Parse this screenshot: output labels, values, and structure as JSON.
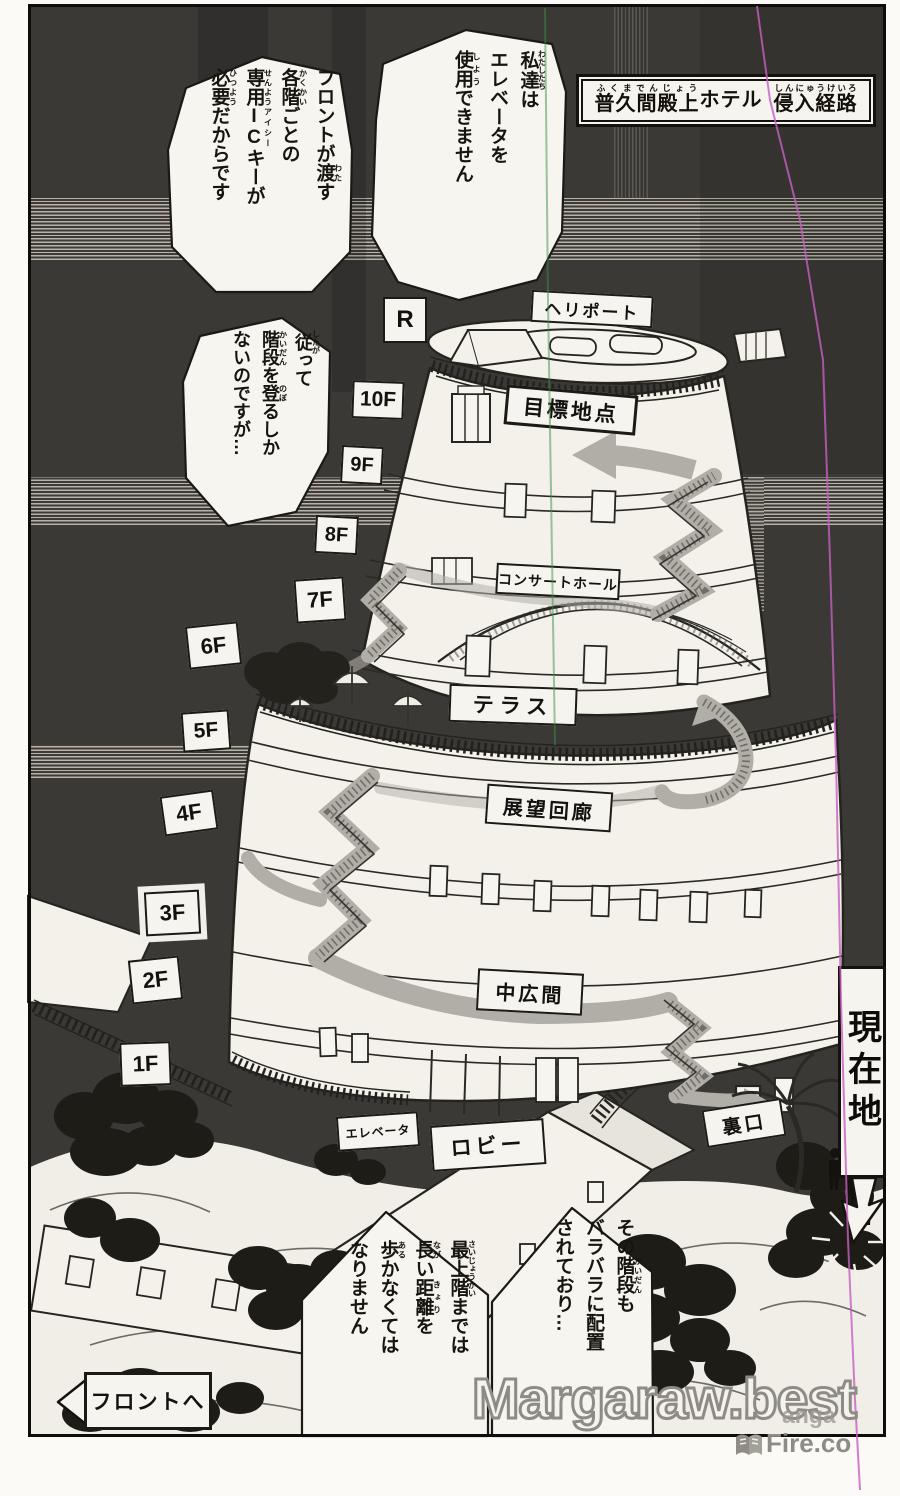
{
  "page": {
    "paper_color": "#f6f4ee",
    "panel_color": "#3b3936",
    "ink_color": "#1c1a16",
    "route_gray": "#b1aea7",
    "scanline_magenta": "#c55fc2",
    "scanline_green": "#3a8f47"
  },
  "title": {
    "segments": [
      {
        "b": "普久間殿上",
        "r": "ふくまでんじょう"
      },
      {
        "b": "ホテル"
      },
      {
        "b": " "
      },
      {
        "b": "侵入経路",
        "r": "しんにゅうけいろ"
      }
    ]
  },
  "floors": [
    "R",
    "10F",
    "9F",
    "8F",
    "7F",
    "6F",
    "5F",
    "4F",
    "3F",
    "2F",
    "1F"
  ],
  "map_labels": {
    "heliport": "ヘリポート",
    "goal": "目標地点",
    "concert_hall": "コンサートホール",
    "terrace": "テラス",
    "observation_corridor": "展望回廊",
    "middle_hall": "中広間",
    "elevator": "エレベータ",
    "lobby": "ロビー",
    "back_entrance": "裏口",
    "current_location": "現在地",
    "to_front_desk": "フロントへ"
  },
  "bubbles": [
    {
      "id": "we-cannot-use-elevator",
      "lines": [
        [
          {
            "b": "私達",
            "r": "わたしたち"
          },
          {
            "b": "は"
          }
        ],
        [
          {
            "b": "エレベータを"
          }
        ],
        [
          {
            "b": "使用",
            "r": "しよう"
          },
          {
            "b": "できません"
          }
        ]
      ]
    },
    {
      "id": "front-desk-ic-key",
      "lines": [
        [
          {
            "b": "フロントが"
          },
          {
            "b": "渡",
            "r": "わた"
          },
          {
            "b": "す"
          }
        ],
        [
          {
            "b": "各階",
            "r": "かくかい"
          },
          {
            "b": "ごとの"
          }
        ],
        [
          {
            "b": "専用",
            "r": "せんよう"
          },
          {
            "b": "IC",
            "r": "アイシー",
            "u": true
          },
          {
            "b": "キーが"
          }
        ],
        [
          {
            "b": "必要",
            "r": "ひつよう"
          },
          {
            "b": "だからです"
          }
        ]
      ]
    },
    {
      "id": "must-climb-stairs",
      "lines": [
        [
          {
            "b": "従",
            "r": "したが"
          },
          {
            "b": "って"
          }
        ],
        [
          {
            "b": "階段",
            "r": "かいだん"
          },
          {
            "b": "を"
          },
          {
            "b": "登",
            "r": "のぼ"
          },
          {
            "b": "るしか"
          }
        ],
        [
          {
            "b": "ないのですが…"
          }
        ]
      ]
    },
    {
      "id": "stairs-scattered",
      "lines": [
        [
          {
            "b": "その"
          },
          {
            "b": "階段",
            "r": "かいだん"
          },
          {
            "b": "も"
          }
        ],
        [
          {
            "b": "バラバラに配置"
          }
        ],
        [
          {
            "b": "されており…"
          }
        ]
      ]
    },
    {
      "id": "long-walk-to-top",
      "lines": [
        [
          {
            "b": "最上階",
            "r": "さいじょうかい"
          },
          {
            "b": "までは"
          }
        ],
        [
          {
            "b": "長",
            "r": "なが"
          },
          {
            "b": "い"
          },
          {
            "b": "距離",
            "r": "きょり"
          },
          {
            "b": "を"
          }
        ],
        [
          {
            "b": "歩",
            "r": "ある"
          },
          {
            "b": "かなくては"
          }
        ],
        [
          {
            "b": "なりません"
          }
        ]
      ]
    }
  ],
  "watermarks": {
    "main": "Margaraw.best",
    "site_prefix": "anga",
    "site": "Fire.co"
  }
}
